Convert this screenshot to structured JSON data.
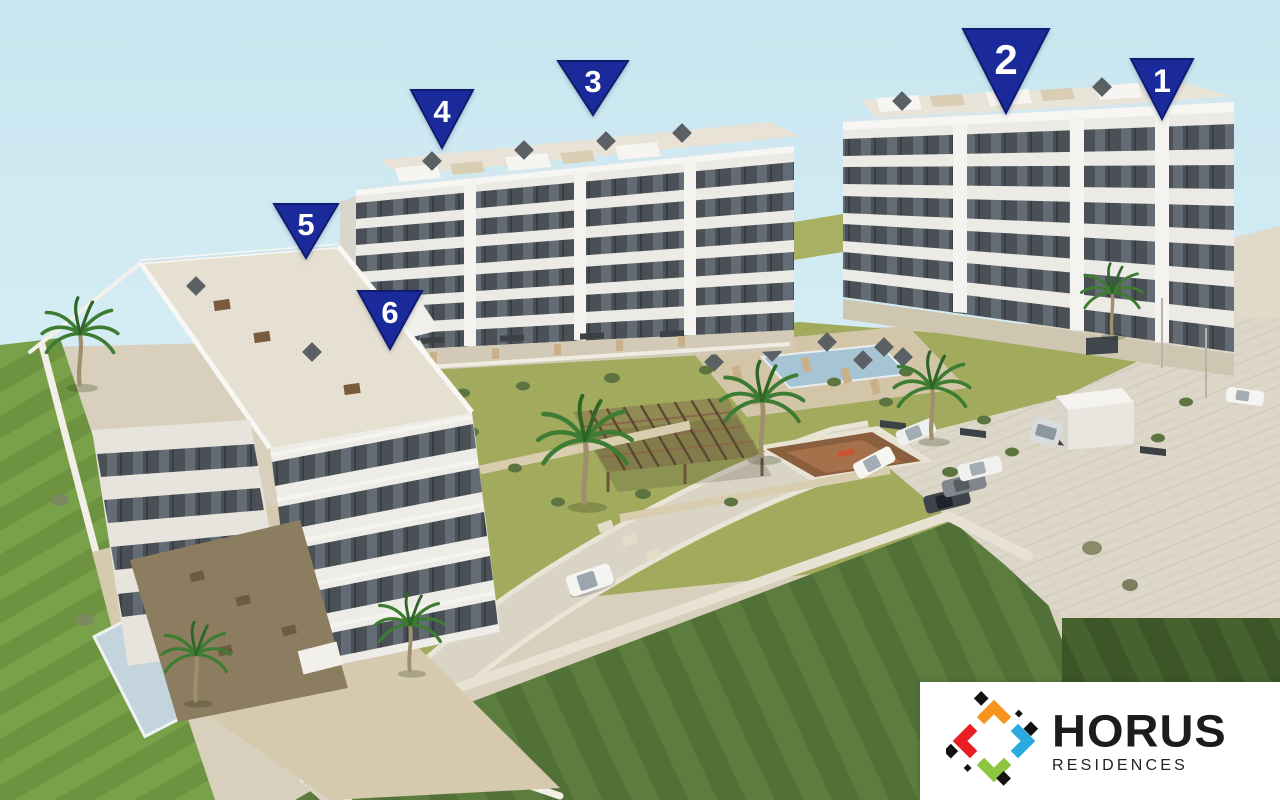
{
  "scene": {
    "alt": "Aerial 3D rendering of the Horus Residences complex: three white apartment buildings with dark glass balconies, landscaped gardens, swimming pools, pergola, palm trees, internal roads and parked cars, annotated with six numbered blue triangular markers",
    "marker_color": "#1a2a9b",
    "marker_outline": "#111c6e",
    "markers": [
      {
        "label": "1"
      },
      {
        "label": "2"
      },
      {
        "label": "3"
      },
      {
        "label": "4"
      },
      {
        "label": "5"
      },
      {
        "label": "6"
      }
    ]
  },
  "logo": {
    "brand": "HORUS",
    "subtitle": "RESIDENCES",
    "text_color": "#1c1c1c",
    "background": "#ffffff",
    "icon_colors": {
      "orange": "#F7941D",
      "blue": "#29ABE2",
      "red": "#EA1D25",
      "green": "#8CC63F",
      "black": "#121212"
    }
  },
  "palette": {
    "sky": "#cde9f2",
    "grass_bright": "#7ba24c",
    "grass_olive": "#a2aa5e",
    "field_green": "#5d7d3f",
    "field_dark": "#3f5a2c",
    "road": "#d9d4c6",
    "deck": "#d2c5a8",
    "pool_water": "#a6c4d4",
    "facade_white": "#eceae4",
    "window_band": "#4a5056"
  }
}
